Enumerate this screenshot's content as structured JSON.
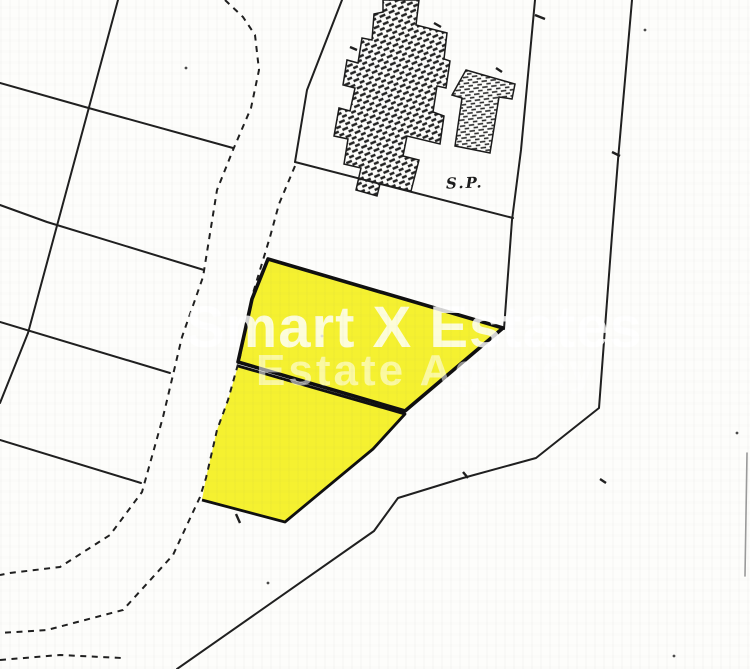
{
  "labels": {
    "survey_point": "S.P."
  },
  "watermark": {
    "line1": "Smart X Estates",
    "line2": "Estate Agency"
  },
  "plan": {
    "width": 750,
    "height": 669,
    "colors": {
      "background": "#fdfdfb",
      "line": "#1f1f1f",
      "plot_fill": "#f5f130",
      "plot_border": "#0f0f0f",
      "building_stroke": "#1a1a1a",
      "hatch": "#222222",
      "speck": "#4a4a4a",
      "scan_edge": "#9a9a9a"
    },
    "solid_lines": [
      {
        "name": "parcel-line-vertical",
        "points": [
          [
            118,
            0
          ],
          [
            28,
            333
          ],
          [
            0,
            403
          ]
        ],
        "w": 2
      },
      {
        "name": "parcel-line-1",
        "points": [
          [
            0,
            83
          ],
          [
            85,
            107
          ],
          [
            233,
            148
          ]
        ],
        "w": 2
      },
      {
        "name": "parcel-line-2",
        "points": [
          [
            0,
            205
          ],
          [
            47,
            222
          ],
          [
            204,
            270
          ]
        ],
        "w": 2
      },
      {
        "name": "parcel-line-3",
        "points": [
          [
            0,
            322
          ],
          [
            170,
            373
          ]
        ],
        "w": 2
      },
      {
        "name": "parcel-line-4",
        "points": [
          [
            0,
            440
          ],
          [
            141,
            483
          ]
        ],
        "w": 2
      },
      {
        "name": "road-edge-upper-left",
        "points": [
          [
            342,
            0
          ],
          [
            307,
            90
          ],
          [
            295,
            162
          ]
        ],
        "w": 2
      },
      {
        "name": "sp-parcel-boundary",
        "points": [
          [
            295,
            162
          ],
          [
            513,
            218
          ]
        ],
        "w": 2
      },
      {
        "name": "road-west-edge",
        "points": [
          [
            535,
            0
          ],
          [
            521,
            150
          ],
          [
            512,
            220
          ],
          [
            504,
            329
          ]
        ],
        "w": 2
      },
      {
        "name": "road-east-edge",
        "points": [
          [
            632,
            0
          ],
          [
            618,
            160
          ],
          [
            612,
            235
          ],
          [
            599,
            408
          ],
          [
            536,
            458
          ],
          [
            463,
            478
          ],
          [
            398,
            498
          ],
          [
            374,
            531
          ],
          [
            177,
            669
          ]
        ],
        "w": 2
      },
      {
        "name": "scan-edge-artifact",
        "points": [
          [
            747,
            453
          ],
          [
            745,
            576
          ]
        ],
        "w": 1.6,
        "color": "#9a9a9a"
      }
    ],
    "dashed_lines": [
      {
        "name": "road-dashed-west",
        "points": [
          [
            225,
            0
          ],
          [
            243,
            17
          ],
          [
            255,
            35
          ],
          [
            259,
            70
          ],
          [
            251,
            108
          ],
          [
            233,
            150
          ],
          [
            217,
            190
          ],
          [
            203,
            277
          ],
          [
            182,
            337
          ],
          [
            163,
            417
          ],
          [
            142,
            492
          ],
          [
            110,
            535
          ],
          [
            60,
            567
          ],
          [
            10,
            573
          ],
          [
            0,
            575
          ]
        ]
      },
      {
        "name": "road-dashed-east",
        "points": [
          [
            295,
            166
          ],
          [
            279,
            204
          ],
          [
            270,
            237
          ],
          [
            253,
            293
          ],
          [
            240,
            357
          ],
          [
            228,
            400
          ],
          [
            217,
            430
          ],
          [
            206,
            478
          ],
          [
            200,
            497
          ],
          [
            173,
            555
          ],
          [
            123,
            610
          ],
          [
            47,
            630
          ],
          [
            0,
            633
          ]
        ]
      },
      {
        "name": "road-dashed-bottom",
        "points": [
          [
            0,
            660
          ],
          [
            60,
            655
          ],
          [
            122,
            658
          ]
        ]
      }
    ],
    "plots": [
      {
        "name": "plot-upper",
        "fill_points": [
          [
            268,
            259
          ],
          [
            503,
            328
          ],
          [
            405,
            411
          ],
          [
            238,
            362
          ],
          [
            245,
            331
          ],
          [
            252,
            299
          ]
        ],
        "border_points": [
          [
            268,
            259
          ],
          [
            503,
            328
          ],
          [
            405,
            411
          ],
          [
            238,
            362
          ],
          [
            245,
            331
          ],
          [
            252,
            299
          ]
        ],
        "closed": true,
        "bw": 3.6
      },
      {
        "name": "plot-lower",
        "fill_points": [
          [
            238,
            366
          ],
          [
            405,
            414
          ],
          [
            373,
            449
          ],
          [
            285,
            522
          ],
          [
            202,
            500
          ],
          [
            206,
            478
          ],
          [
            217,
            430
          ],
          [
            228,
            400
          ]
        ],
        "border_points": [
          [
            238,
            366
          ],
          [
            405,
            414
          ],
          [
            373,
            449
          ],
          [
            285,
            522
          ],
          [
            202,
            500
          ]
        ],
        "closed": false,
        "bw": 2.8
      }
    ],
    "buildings": [
      {
        "name": "building-large",
        "pattern": "hatch-diag",
        "points": [
          [
            383,
            0
          ],
          [
            419,
            0
          ],
          [
            416,
            25
          ],
          [
            447,
            33
          ],
          [
            444,
            59
          ],
          [
            450,
            61
          ],
          [
            446,
            88
          ],
          [
            437,
            86
          ],
          [
            433,
            112
          ],
          [
            444,
            116
          ],
          [
            440,
            144
          ],
          [
            407,
            136
          ],
          [
            403,
            156
          ],
          [
            419,
            160
          ],
          [
            411,
            191
          ],
          [
            380,
            184
          ],
          [
            377,
            196
          ],
          [
            356,
            190
          ],
          [
            361,
            168
          ],
          [
            344,
            164
          ],
          [
            348,
            139
          ],
          [
            334,
            136
          ],
          [
            339,
            108
          ],
          [
            350,
            111
          ],
          [
            355,
            88
          ],
          [
            343,
            85
          ],
          [
            347,
            60
          ],
          [
            358,
            63
          ],
          [
            362,
            38
          ],
          [
            372,
            40
          ],
          [
            374,
            14
          ],
          [
            383,
            12
          ]
        ]
      },
      {
        "name": "building-small",
        "pattern": "hatch-horiz",
        "points": [
          [
            466,
            70
          ],
          [
            515,
            84
          ],
          [
            512,
            99
          ],
          [
            499,
            97
          ],
          [
            490,
            153
          ],
          [
            455,
            146
          ],
          [
            462,
            98
          ],
          [
            452,
            95
          ]
        ]
      }
    ],
    "ticks": [
      [
        [
          535,
          15
        ],
        [
          545,
          19
        ]
      ],
      [
        [
          612,
          152
        ],
        [
          620,
          156
        ]
      ],
      [
        [
          434,
          23
        ],
        [
          441,
          27
        ]
      ],
      [
        [
          350,
          47
        ],
        [
          357,
          50
        ]
      ],
      [
        [
          496,
          68
        ],
        [
          502,
          72
        ]
      ],
      [
        [
          463,
          472
        ],
        [
          468,
          478
        ]
      ],
      [
        [
          236,
          514
        ],
        [
          240,
          523
        ]
      ],
      [
        [
          600,
          479
        ],
        [
          606,
          483
        ]
      ]
    ],
    "specks": [
      [
        186,
        68
      ],
      [
        645,
        30
      ],
      [
        322,
        336
      ],
      [
        737,
        433
      ],
      [
        674,
        656
      ],
      [
        268,
        583
      ]
    ]
  }
}
